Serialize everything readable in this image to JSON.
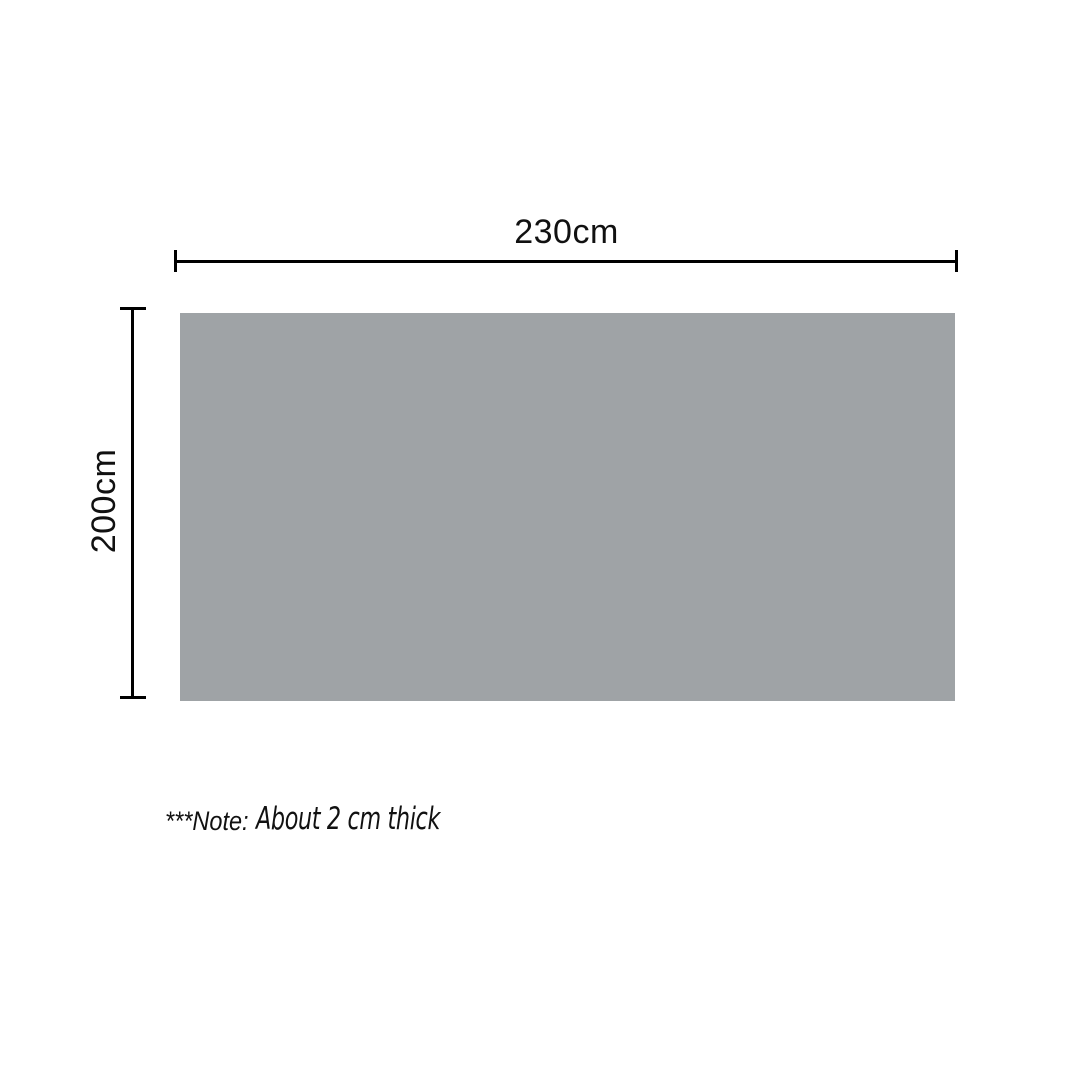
{
  "diagram": {
    "width_dimension": {
      "label": "230cm",
      "value_cm": 230
    },
    "height_dimension": {
      "label": "200cm",
      "value_cm": 200
    },
    "note": {
      "prefix": "***Note:",
      "text": "About 2 cm thick"
    }
  },
  "colors": {
    "background": "#ffffff",
    "surface": "#9fa3a6",
    "line": "#000000",
    "text": "#111111"
  }
}
